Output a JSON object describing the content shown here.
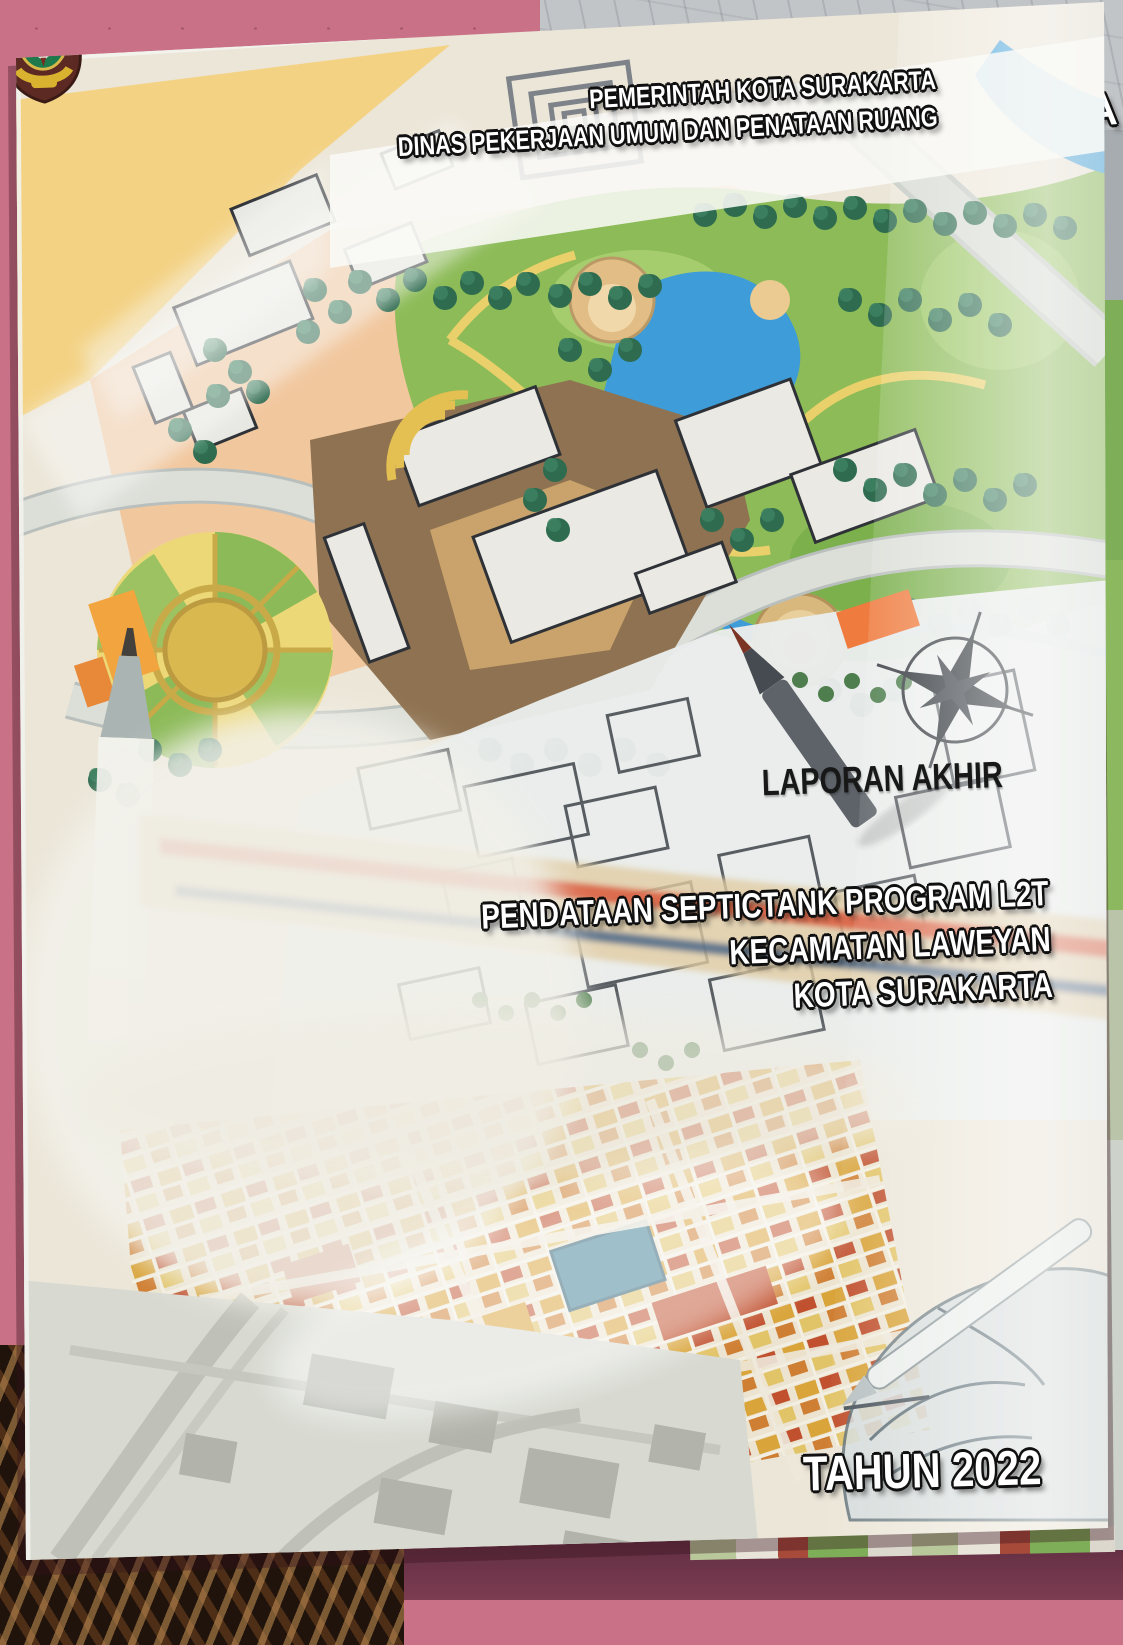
{
  "scene": {
    "description": "Photograph of a glossy printed report cover lying on a pink speckled table, woven basket at bottom-left, second report copy and sketch sheet behind",
    "table_color": "#c97186",
    "background_fragment_text": "NA"
  },
  "cover": {
    "header": {
      "line1": "PEMERINTAH KOTA SURAKARTA",
      "line2": "DINAS PEKERJAAN UMUM DAN PENATAAN RUANG"
    },
    "crest": {
      "name": "surakarta-city-crest",
      "shield_color": "#5c2a22",
      "field_color": "#1e7a4c",
      "laurel_color": "#d9b330"
    },
    "report_type": "LAPORAN AKHIR",
    "title": {
      "line1": "PENDATAAN SEPTICTANK PROGRAM L2T",
      "line2": "KECAMATAN LAWEYAN",
      "line3": "KOTA SURAKARTA"
    },
    "year": "TAHUN 2022",
    "art": {
      "map_green": "#8cbb57",
      "map_peach": "#f1c79e",
      "water_blue": "#3e9cd8",
      "plaza_brown": "#8e7251",
      "tree_green": "#2e6b4f",
      "accent_orange": "#ef7b3e",
      "ruler_red": "#db6246",
      "ruler_blue": "#4c6a8a"
    }
  }
}
